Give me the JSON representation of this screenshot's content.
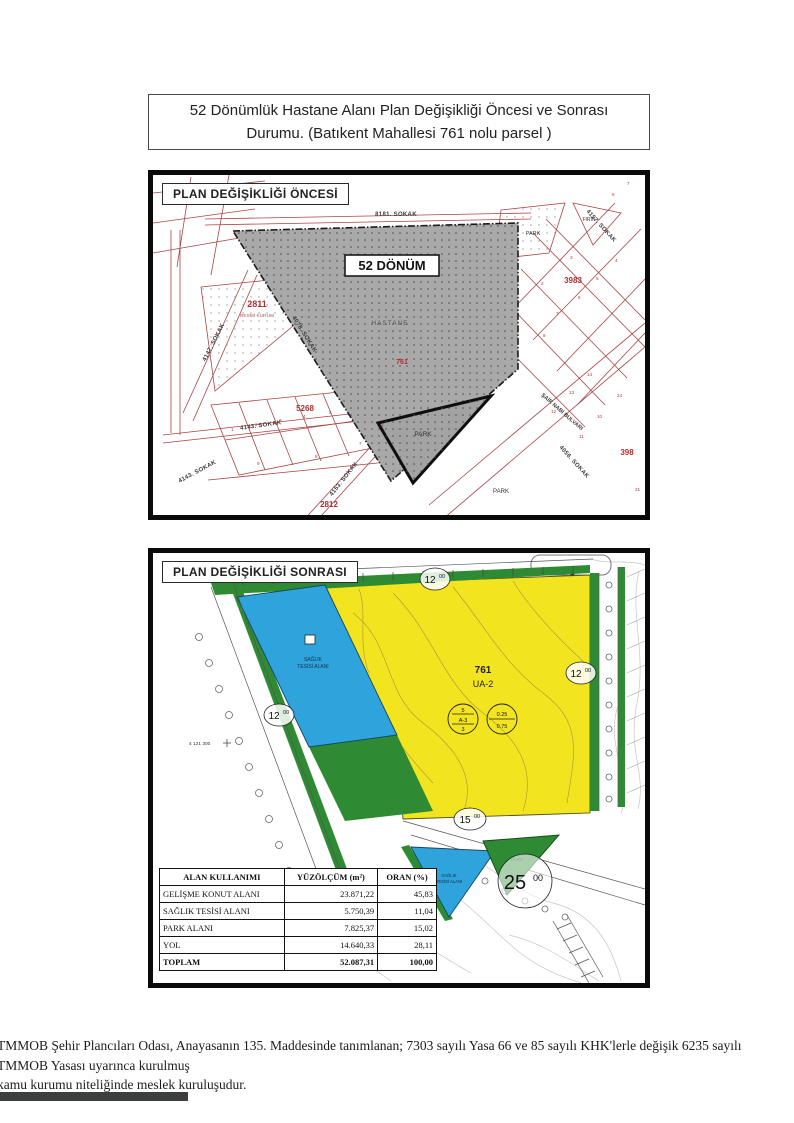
{
  "title": "52 Dönümlük Hastane Alanı Plan Değişikliği Öncesi ve Sonrası Durumu. (Batıkent Mahallesi 761 nolu parsel )",
  "colors": {
    "yellow": "#f2e41f",
    "blue": "#2fa3dc",
    "green": "#2e8b33",
    "gray": "#a9a9a9",
    "red_line": "#a94442"
  },
  "map_before": {
    "header": "PLAN DEĞİŞİKLİĞİ ÖNCESİ",
    "donum_label": "52 DÖNÜM",
    "hastane_label": "HASTANE",
    "parcel_761": "761",
    "park_label": "PARK",
    "firin_label": "FIRIN",
    "resmi_kurum_label": "RESMİ KURUM",
    "parcel_2811": "2811",
    "parcel_5268": "5268",
    "parcel_2812": "2812",
    "parcel_3983": "3983",
    "parcel_398": "398",
    "street_8181": "8181. SOKAK",
    "street_4147": "4147. SOKAK",
    "street_4078": "4078. SOKAK",
    "street_4143": "4143. SOKAK",
    "street_4153": "4153. SOKAK",
    "street_4056": "4056. SOKAK",
    "street_4157": "4157. SOKAK",
    "street_sair_nabi": "ŞAİR NABİ BULVARI",
    "lots": [
      "1",
      "2",
      "3",
      "4",
      "5",
      "9",
      "8",
      "7",
      "6",
      "2",
      "3",
      "4",
      "5",
      "6",
      "7",
      "8",
      "10",
      "11",
      "12",
      "13",
      "14",
      "24",
      "21",
      "7",
      "6"
    ]
  },
  "map_after": {
    "header": "PLAN DEĞİŞİKLİĞİ SONRASI",
    "parcel": "761",
    "zone": "UA-2",
    "zoning_circle_a": {
      "l1": "5",
      "l2": "A-3",
      "l3": "3"
    },
    "zoning_circle_b": {
      "top": "0.25",
      "bottom": "0.75"
    },
    "road_width_12": {
      "main": "12",
      "sup": "00"
    },
    "road_width_15": {
      "main": "15",
      "sup": "00"
    },
    "road_width_25": {
      "main": "25",
      "sup": "00"
    },
    "coord_label": "4 121 300",
    "health_label_l1": "SAĞLIK",
    "health_label_l2": "TESİSİ ALANI",
    "park_label": "PARK",
    "table": {
      "headers": [
        "ALAN KULLANIMI",
        "YÜZÖLÇÜM (m²)",
        "ORAN (%)"
      ],
      "rows": [
        [
          "GELİŞME KONUT ALANI",
          "23.871,22",
          "45,83"
        ],
        [
          "SAĞLIK TESİSİ ALANI",
          "5.750,39",
          "11,04"
        ],
        [
          "PARK ALANI",
          "7.825,37",
          "15,02"
        ],
        [
          "YOL",
          "14.640,33",
          "28,11"
        ],
        [
          "TOPLAM",
          "52.087,31",
          "100,00"
        ]
      ]
    }
  },
  "footer": {
    "line1": "TMMOB Şehir Plancıları Odası, Anayasanın 135. Maddesinde tanımlanan; 7303 sayılı Yasa 66 ve 85 sayılı KHK'lerle değişik 6235 sayılı TMMOB Yasası uyarınca kurulmuş",
    "line2": "kamu kurumu niteliğinde meslek kuruluşudur."
  }
}
